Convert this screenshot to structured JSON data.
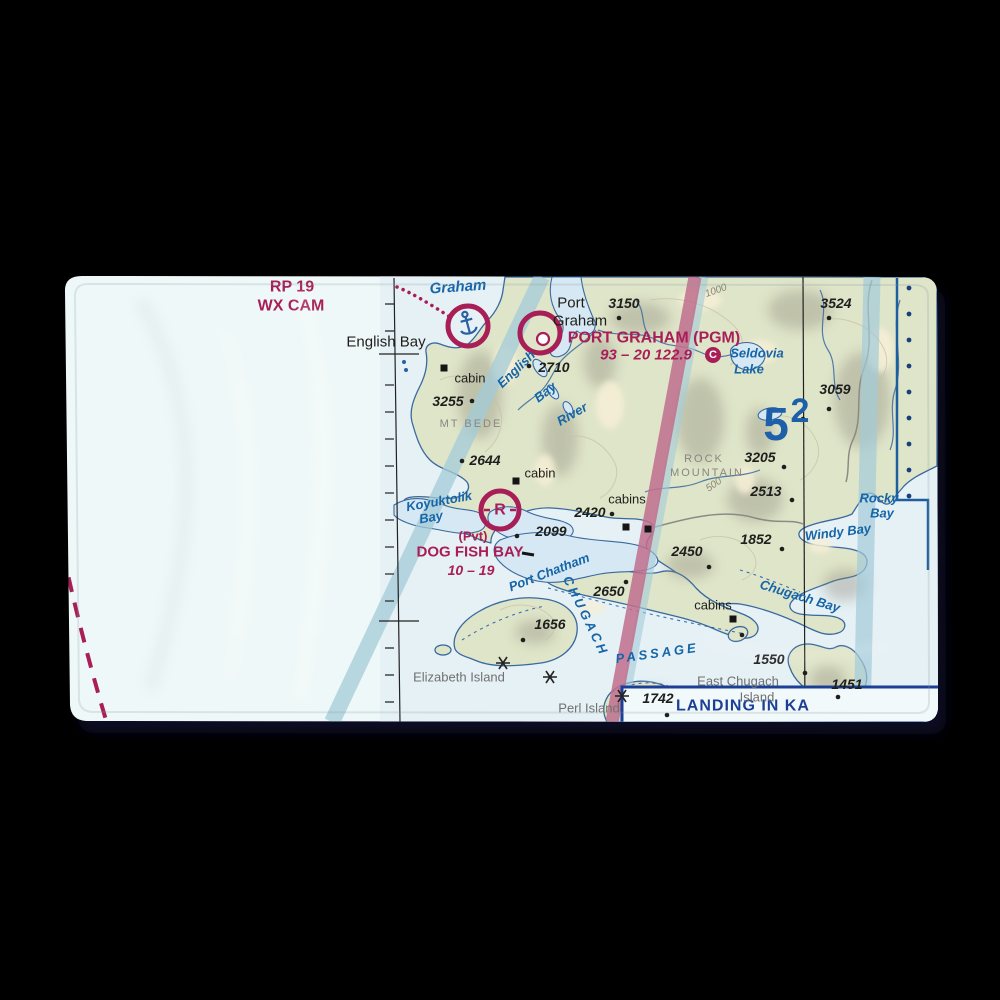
{
  "colors": {
    "background": "#000000",
    "towel": "#eff8f8",
    "sea": "#e6f1f5",
    "land": "#dfe5c9",
    "coast": "#39699f",
    "magenta": "#a81e56",
    "water": "#1565a8",
    "mef": "#1d5fa8",
    "band_teal": "#a3cbd8",
    "band_pink": "#c06e8d",
    "landing_blue": "#1c3f96"
  },
  "map": {
    "landing_box": {
      "label": "LANDING IN KA"
    },
    "mef_figure": "52",
    "airport_data": {
      "port_graham": {
        "name": "PORT GRAHAM (PGM)",
        "info": "93 – 20 122.9",
        "ctaf_symbol": "C"
      },
      "dog_fish_bay": {
        "ownership": "(Pvt)",
        "name": "DOG FISH BAY",
        "info": "10 – 19",
        "symbol": "R"
      },
      "english_bay": {
        "remarks": [
          "RP 19",
          "WX CAM"
        ]
      }
    },
    "labels": [
      {
        "t": "RP 19",
        "x": 292,
        "y": 287,
        "c": "mag",
        "s": 16
      },
      {
        "t": "WX CAM",
        "x": 291,
        "y": 306,
        "c": "mag",
        "s": 16
      },
      {
        "t": "English Bay",
        "x": 386,
        "y": 342,
        "c": "blk",
        "s": 15
      },
      {
        "t": "Graham",
        "x": 458,
        "y": 287,
        "c": "wat",
        "s": 15,
        "r": -4
      },
      {
        "t": "cabin",
        "x": 470,
        "y": 378,
        "c": "blk",
        "s": 13
      },
      {
        "t": "3255",
        "x": 448,
        "y": 401,
        "c": "elev",
        "s": 14
      },
      {
        "t": "MT BEDE",
        "x": 471,
        "y": 424,
        "c": "gcaps",
        "s": 11
      },
      {
        "t": "2644",
        "x": 485,
        "y": 460,
        "c": "elev",
        "s": 14
      },
      {
        "t": "cabin",
        "x": 540,
        "y": 473,
        "c": "blk",
        "s": 13
      },
      {
        "t": "Koyuktolik",
        "x": 439,
        "y": 501,
        "c": "wat",
        "s": 13,
        "r": -10
      },
      {
        "t": "Bay",
        "x": 431,
        "y": 517,
        "c": "wat",
        "s": 13,
        "r": -10
      },
      {
        "t": "(Pvt)",
        "x": 473,
        "y": 536,
        "c": "mag",
        "s": 13
      },
      {
        "t": "DOG FISH BAY",
        "x": 470,
        "y": 552,
        "c": "mag",
        "s": 15
      },
      {
        "t": "10 – 19",
        "x": 471,
        "y": 570,
        "c": "magI",
        "s": 14
      },
      {
        "t": "2099",
        "x": 551,
        "y": 531,
        "c": "elev",
        "s": 14
      },
      {
        "t": "2420",
        "x": 590,
        "y": 512,
        "c": "elev",
        "s": 14
      },
      {
        "t": "cabins",
        "x": 627,
        "y": 499,
        "c": "blk",
        "s": 13
      },
      {
        "t": "Port",
        "x": 571,
        "y": 303,
        "c": "blk",
        "s": 15
      },
      {
        "t": "Graham",
        "x": 580,
        "y": 321,
        "c": "blk",
        "s": 15
      },
      {
        "t": "3150",
        "x": 624,
        "y": 303,
        "c": "elev",
        "s": 14
      },
      {
        "t": "PORT GRAHAM (PGM)",
        "x": 654,
        "y": 338,
        "c": "mag",
        "s": 16
      },
      {
        "t": "93 – 20 122.9",
        "x": 646,
        "y": 355,
        "c": "magI",
        "s": 15
      },
      {
        "t": "C",
        "x": 713,
        "y": 355,
        "c": "ctaf",
        "s": 11
      },
      {
        "t": "English",
        "x": 516,
        "y": 369,
        "c": "wat",
        "s": 13,
        "r": -44
      },
      {
        "t": "Bay",
        "x": 545,
        "y": 392,
        "c": "wat",
        "s": 13,
        "r": -38
      },
      {
        "t": "River",
        "x": 572,
        "y": 414,
        "c": "wat",
        "s": 13,
        "r": -30
      },
      {
        "t": "2710",
        "x": 554,
        "y": 367,
        "c": "elev",
        "s": 14
      },
      {
        "t": "Seldovia",
        "x": 757,
        "y": 353,
        "c": "wat",
        "s": 13
      },
      {
        "t": "Lake",
        "x": 749,
        "y": 369,
        "c": "wat",
        "s": 13
      },
      {
        "t": "3524",
        "x": 836,
        "y": 303,
        "c": "elev",
        "s": 14
      },
      {
        "t": "3059",
        "x": 835,
        "y": 389,
        "c": "elev",
        "s": 14
      },
      {
        "t": "5",
        "x": 776,
        "y": 424,
        "c": "mef",
        "s": 46
      },
      {
        "t": "2",
        "x": 800,
        "y": 411,
        "c": "mef",
        "s": 34
      },
      {
        "t": "1000",
        "x": 716,
        "y": 291,
        "c": "cont",
        "s": 10,
        "r": -20
      },
      {
        "t": "ROCK",
        "x": 704,
        "y": 459,
        "c": "gcaps",
        "s": 11
      },
      {
        "t": "MOUNTAIN",
        "x": 707,
        "y": 473,
        "c": "gcaps",
        "s": 11
      },
      {
        "t": "3205",
        "x": 760,
        "y": 457,
        "c": "elev",
        "s": 14
      },
      {
        "t": "500",
        "x": 714,
        "y": 485,
        "c": "cont",
        "s": 10,
        "r": -35
      },
      {
        "t": "2513",
        "x": 766,
        "y": 491,
        "c": "elev",
        "s": 14
      },
      {
        "t": "1852",
        "x": 756,
        "y": 539,
        "c": "elev",
        "s": 14
      },
      {
        "t": "2450",
        "x": 687,
        "y": 551,
        "c": "elev",
        "s": 14
      },
      {
        "t": "Windy Bay",
        "x": 838,
        "y": 532,
        "c": "wat",
        "s": 13,
        "r": -7
      },
      {
        "t": "Rocky",
        "x": 879,
        "y": 498,
        "c": "wat",
        "s": 13
      },
      {
        "t": "Bay",
        "x": 882,
        "y": 513,
        "c": "wat",
        "s": 13
      },
      {
        "t": "2650",
        "x": 609,
        "y": 591,
        "c": "elev",
        "s": 14
      },
      {
        "t": "CHUGACH",
        "x": 586,
        "y": 616,
        "c": "wcaps",
        "s": 13,
        "r": 64
      },
      {
        "t": "PASSAGE",
        "x": 657,
        "y": 653,
        "c": "wcaps",
        "s": 13,
        "r": -8
      },
      {
        "t": "cabins",
        "x": 713,
        "y": 605,
        "c": "blk",
        "s": 13
      },
      {
        "t": "Chugach Bay",
        "x": 800,
        "y": 596,
        "c": "wat",
        "s": 13,
        "r": 17
      },
      {
        "t": "Port Chatham",
        "x": 549,
        "y": 572,
        "c": "wat",
        "s": 13,
        "r": -21
      },
      {
        "t": "1550",
        "x": 769,
        "y": 659,
        "c": "elev",
        "s": 14
      },
      {
        "t": "East Chugach",
        "x": 738,
        "y": 681,
        "c": "gry",
        "s": 13
      },
      {
        "t": "Island",
        "x": 757,
        "y": 697,
        "c": "gry",
        "s": 13
      },
      {
        "t": "1451",
        "x": 847,
        "y": 684,
        "c": "elev",
        "s": 14
      },
      {
        "t": "1656",
        "x": 550,
        "y": 624,
        "c": "elev",
        "s": 14
      },
      {
        "t": "Elizabeth Island",
        "x": 459,
        "y": 677,
        "c": "gry",
        "s": 13
      },
      {
        "t": "1742",
        "x": 658,
        "y": 698,
        "c": "elev",
        "s": 14
      },
      {
        "t": "Perl Island",
        "x": 589,
        "y": 708,
        "c": "gry",
        "s": 13
      }
    ],
    "spot_dots": [
      [
        472,
        401
      ],
      [
        462,
        461
      ],
      [
        517,
        536
      ],
      [
        612,
        514
      ],
      [
        619,
        318
      ],
      [
        529,
        366
      ],
      [
        829,
        318
      ],
      [
        829,
        409
      ],
      [
        784,
        467
      ],
      [
        792,
        500
      ],
      [
        782,
        549
      ],
      [
        709,
        567
      ],
      [
        626,
        582
      ],
      [
        742,
        635
      ],
      [
        838,
        697
      ],
      [
        523,
        640
      ],
      [
        667,
        715
      ],
      [
        805,
        673
      ],
      [
        803,
        419
      ]
    ],
    "blue_dots": [
      [
        404,
        362
      ],
      [
        406,
        370
      ]
    ],
    "squares": [
      [
        444,
        368
      ],
      [
        516,
        481
      ],
      [
        626,
        527
      ],
      [
        648,
        529
      ],
      [
        733,
        619
      ]
    ],
    "stars": [
      [
        503,
        663
      ],
      [
        550,
        677
      ],
      [
        622,
        696
      ]
    ],
    "boundary_dots_x": 909,
    "boundary_dots_y": [
      288,
      314,
      340,
      366,
      392,
      418,
      444,
      470,
      496
    ],
    "graticule": {
      "tick_y": [
        304,
        331,
        385,
        412,
        439,
        466,
        493,
        520,
        547,
        574,
        601,
        648,
        675,
        702
      ],
      "crossbar_y": [
        354,
        621
      ]
    }
  }
}
